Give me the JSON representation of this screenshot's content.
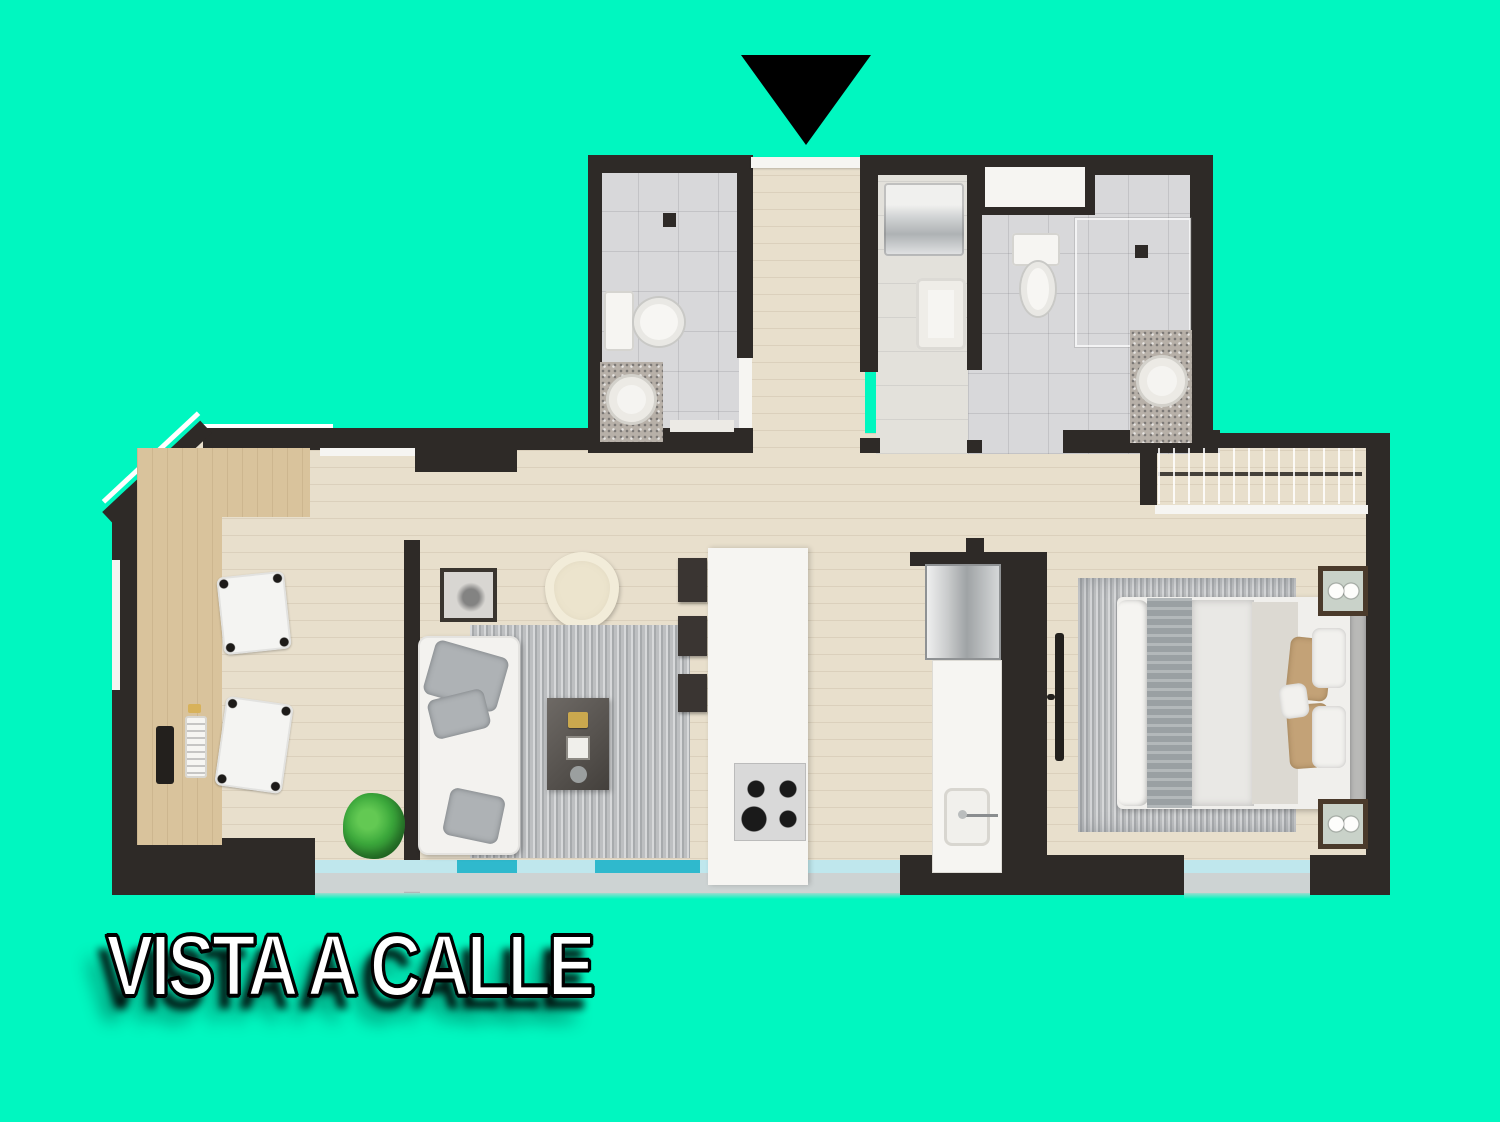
{
  "scene": {
    "type": "apartment-floor-plan-top-view",
    "caption": "VISTA A CALLE",
    "entrance_marker": "triangle-down"
  },
  "colors": {
    "background": "#00F7C0",
    "wall": "#2E2A27",
    "floor": "#E8DFCC",
    "wood": "#D9C39C",
    "tile": "#D8D8DA",
    "fixture": "#F6F5F2",
    "glass_light": "#BFE7ED",
    "glass_bright": "#2FB9CD",
    "sill": "#CDD3D3",
    "granite": "#B7B0A8",
    "rug": "#BDBFC1",
    "plant": "#3CA93C",
    "pillow_tan": "#C3A277",
    "night_fill": "#C9D2C9",
    "night_border": "#4A3A2B",
    "stool": "#3A3532",
    "caption_fill": "#FFFFFF",
    "caption_outline": "#000000"
  },
  "rooms": [
    {
      "name": "bathroom-1"
    },
    {
      "name": "entry-hall"
    },
    {
      "name": "laundry-nook"
    },
    {
      "name": "bathroom-2"
    },
    {
      "name": "walk-in-closet"
    },
    {
      "name": "study-nook"
    },
    {
      "name": "living-room"
    },
    {
      "name": "kitchen"
    },
    {
      "name": "bedroom"
    },
    {
      "name": "street-facing-windows"
    }
  ],
  "fixtures": [
    "entrance-arrow",
    "toilet",
    "shower-head",
    "granite-vanity-round-sink",
    "washer",
    "laundry-sink",
    "high-window",
    "wardrobe-hanging-rail",
    "shelf",
    "double-bed",
    "nightstand-with-lamps",
    "wall-tv",
    "desk-with-tv-and-keyboard",
    "office-chair",
    "sofa-with-cushions",
    "coffee-table",
    "striped-rug",
    "egg-chair",
    "picture-frame",
    "kitchen-island",
    "four-burner-cooktop",
    "fridge",
    "kitchen-sink-counter",
    "bar-stools",
    "plant",
    "balcony-glazing"
  ]
}
